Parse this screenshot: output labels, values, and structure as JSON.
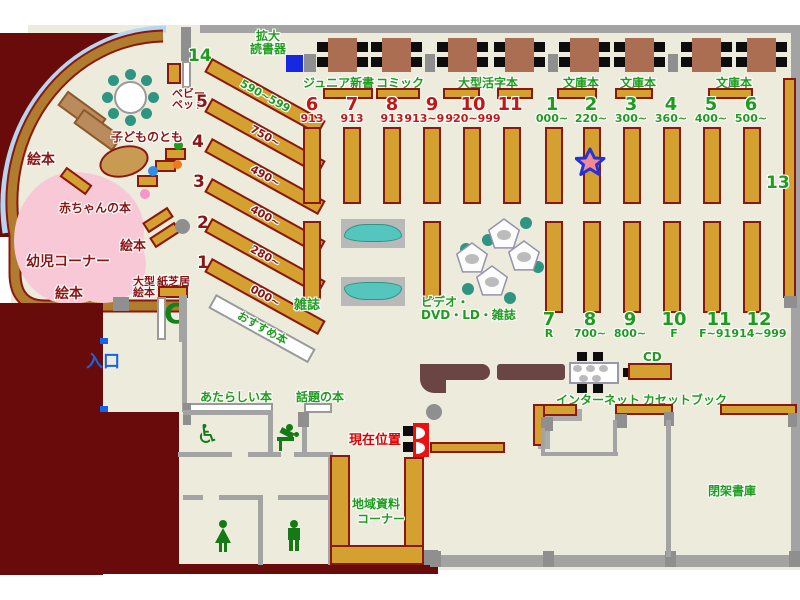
{
  "map_title": "library floor map",
  "colors": {
    "floor": "#EDECDC",
    "outside_wall": "#6A0B0B",
    "shelf": "#D4A02F",
    "shelf_border": "#8B1810",
    "wall_gray": "#A3A3A3",
    "curved_window": "#B5D6F0",
    "curved_wall": "#B07C2E",
    "pink_area": "#F8C8D6",
    "table_brown": "#AC6E52",
    "teal_seat": "#2F9482",
    "counter_brown": "#6B4444",
    "green_text": "#1E9C1E",
    "darkred_text": "#8B1414",
    "red_number": "#C21717",
    "entrance_blue": "#1563E8",
    "marker_red": "#EE0F0F",
    "star_fill": "#F28A94",
    "star_stroke": "#2433D6"
  },
  "labels": {
    "magnifier1": "拡大",
    "magnifier2": "読書器",
    "babybed1": "ベビー",
    "babybed2": "ベッド",
    "kodomo": "子どものとも",
    "ehon": "絵本",
    "akachan": "赤ちゃんの本",
    "youji": "幼児コーナー",
    "ogata1": "大型",
    "kamishibai": "紙芝居",
    "osusume": "おすすめ本",
    "zasshi": "雑誌",
    "video1": "ビデオ・",
    "video2": "DVD・LD・雑誌",
    "iriguchi": "入口",
    "atarashii": "あたらしい本",
    "wadai": "話題の本",
    "genzai": "現在位置",
    "chiiki1": "地域資料",
    "chiiki2": "コーナー",
    "internet": "インターネット",
    "cd": "CD",
    "cassette": "カセットブック",
    "heika": "閉架書庫"
  },
  "table_area_labels": [
    "ジュニア新書",
    "コミック",
    "大型活字本",
    "文庫本",
    "文庫本",
    "文庫本"
  ],
  "shelves": {
    "left_diagonal": [
      {
        "no": "14",
        "range": "590~599"
      },
      {
        "no": "5",
        "range": "750~"
      },
      {
        "no": "4",
        "range": "490~"
      },
      {
        "no": "3",
        "range": "400~"
      },
      {
        "no": "2",
        "range": "280~"
      },
      {
        "no": "1",
        "range": "000~"
      }
    ],
    "mid_top": [
      {
        "no": "6",
        "range": "913"
      },
      {
        "no": "7",
        "range": "913"
      },
      {
        "no": "8",
        "range": "913"
      },
      {
        "no": "9",
        "range": "913~919"
      },
      {
        "no": "10",
        "range": "920~999"
      },
      {
        "no": "11",
        "range": ""
      }
    ],
    "right_top": [
      {
        "no": "1",
        "range": "000~"
      },
      {
        "no": "2",
        "range": "220~"
      },
      {
        "no": "3",
        "range": "300~"
      },
      {
        "no": "4",
        "range": "360~"
      },
      {
        "no": "5",
        "range": "400~"
      },
      {
        "no": "6",
        "range": "500~"
      }
    ],
    "right_bottom": [
      {
        "no": "7",
        "range": "R"
      },
      {
        "no": "8",
        "range": "700~"
      },
      {
        "no": "9",
        "range": "800~"
      },
      {
        "no": "10",
        "range": "F"
      },
      {
        "no": "11",
        "range": "F~914"
      },
      {
        "no": "12",
        "range": "914~999"
      }
    ],
    "right_wall_no": "13"
  }
}
